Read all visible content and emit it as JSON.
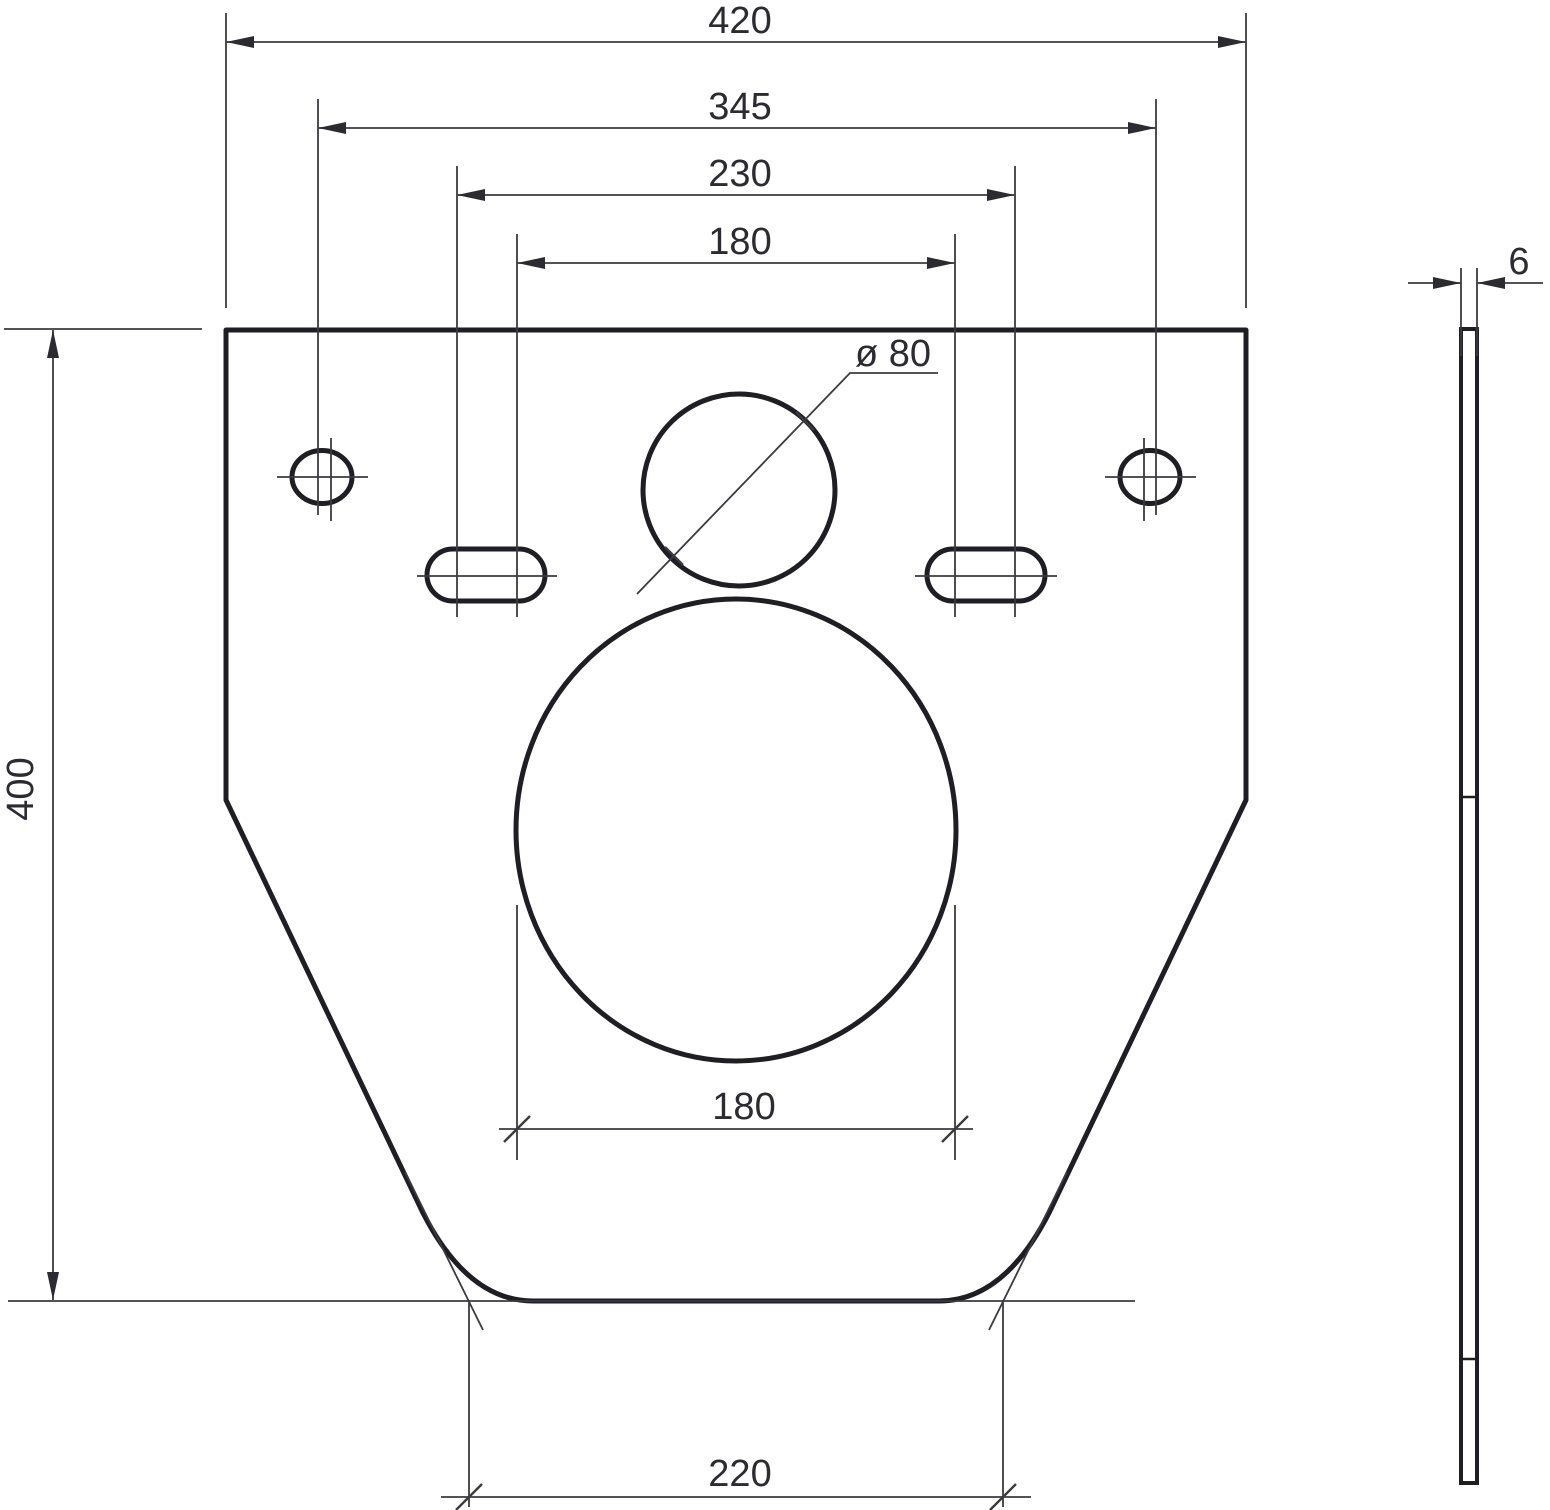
{
  "drawing": {
    "type": "technical-dimension-drawing",
    "views": {
      "front_label": "front view of mounting plate",
      "side_label": "side view of plate thickness"
    },
    "front": {
      "overall_width": "420",
      "frame_hole_spacing": "345",
      "bolt_spacing_wide": "230",
      "bolt_spacing_narrow": "180",
      "overall_height": "400",
      "drain_diameter": "ø 80",
      "outlet_width": "180",
      "base_width": "220"
    },
    "side": {
      "thickness": "6"
    },
    "colors": {
      "outline": "#1e1e24",
      "dimension_lines": "#3a3a40",
      "text": "#2b2b31",
      "background": "#ffffff"
    }
  }
}
